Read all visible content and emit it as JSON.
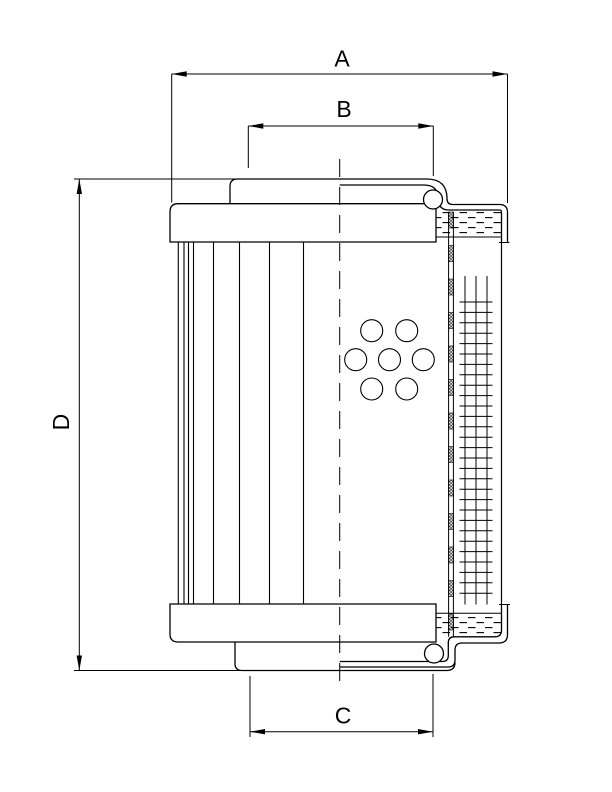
{
  "drawing": {
    "subject": "filter element cross-section technical drawing",
    "background_color": "#ffffff",
    "line_color": "#000000"
  },
  "dimensions": {
    "A": {
      "label": "A",
      "orientation": "horizontal",
      "y": 74,
      "x1": 171.7,
      "x2": 507.5
    },
    "B": {
      "label": "B",
      "orientation": "horizontal",
      "y": 126,
      "x1": 248.3,
      "x2": 433.3
    },
    "C": {
      "label": "C",
      "orientation": "horizontal",
      "y": 731.7,
      "x1": 250,
      "x2": 433
    },
    "D": {
      "label": "D",
      "orientation": "vertical",
      "x": 79.3,
      "y1": 179,
      "y2": 670.5
    }
  },
  "figure": {
    "pleat_lines": {
      "xs": [
        178.3,
        184,
        188.5,
        193.5,
        213.5,
        239.5,
        269.5,
        303.5
      ],
      "y1": 242,
      "y2": 604
    },
    "center_line": {
      "x": 339.7,
      "y1": 159,
      "y2": 685.5,
      "dash": "18 10"
    },
    "perforation_holes": {
      "r": 11,
      "centers": [
        [
          371.7,
          330.7
        ],
        [
          406.7,
          330.7
        ],
        [
          355.7,
          359.7
        ],
        [
          389.5,
          359.7
        ],
        [
          423.3,
          359.7
        ],
        [
          371.7,
          389
        ],
        [
          406.7,
          389
        ]
      ]
    },
    "wire_mesh": {
      "vertical_xs": [
        465,
        476,
        487
      ],
      "v_y1": 276,
      "v_y2": 604.5,
      "h_x1": 459.5,
      "h_x2": 492.5,
      "h_y_start": 302,
      "h_step": 10.4,
      "h_count": 29
    },
    "tube_section_strip": {
      "x": 448.6,
      "width": 4.8,
      "y1": 212,
      "y2": 636.8,
      "block_start": 212,
      "block_height": 16,
      "block_period": 33.5,
      "block_count": 13
    },
    "seal_balls": {
      "r": 9.5,
      "top": [
        433,
        199.5
      ],
      "bottom": [
        434,
        653.5
      ]
    },
    "arrow": {
      "length": 15,
      "half_width": 2.7
    }
  }
}
